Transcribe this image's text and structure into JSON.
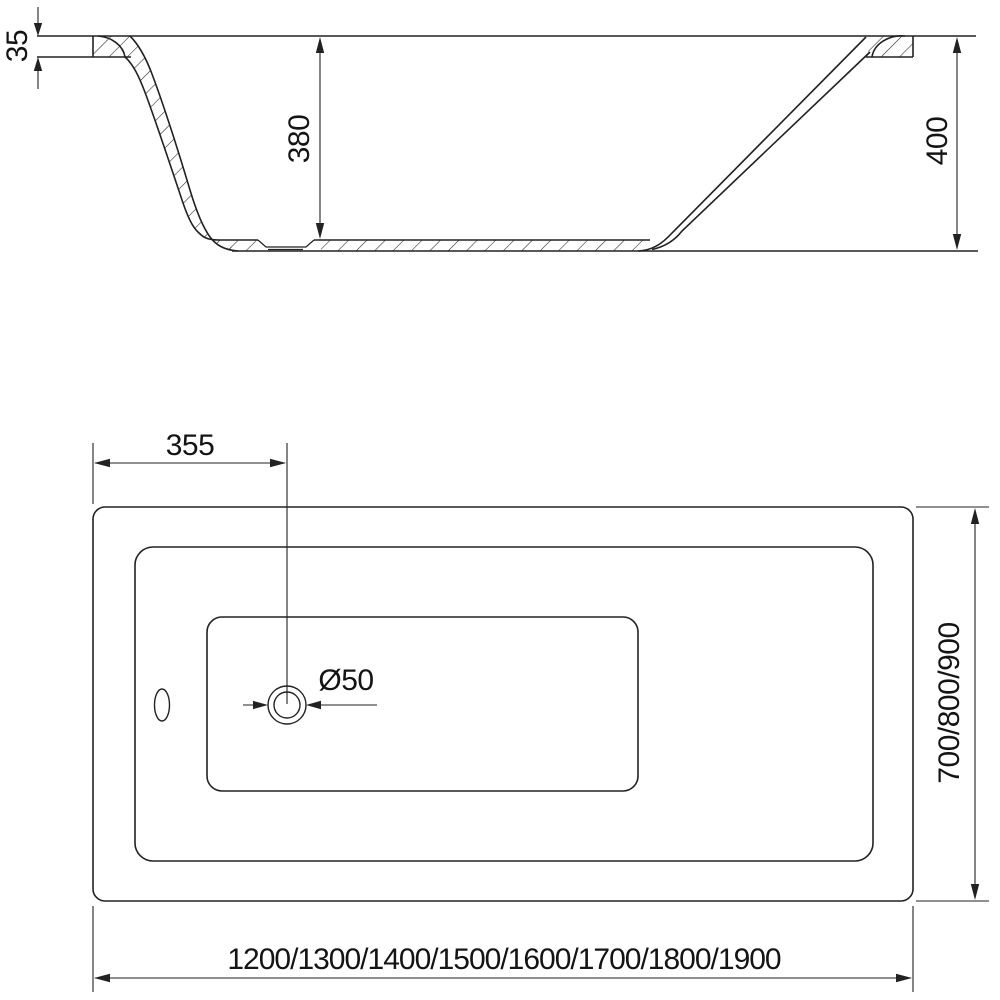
{
  "page": {
    "background": "#ffffff",
    "line_color": "#222222",
    "drawing_subject": "bathtub technical drawing, side section and plan view"
  },
  "side_view": {
    "dim_rim_thickness": "35",
    "dim_inner_depth": "380",
    "dim_total_height": "400"
  },
  "plan_view": {
    "dim_drain_center_offset": "355",
    "dim_drain_diameter": "Ø50",
    "dim_width_options": "700/800/900",
    "dim_length_options": "1200/1300/1400/1500/1600/1700/1800/1900"
  }
}
